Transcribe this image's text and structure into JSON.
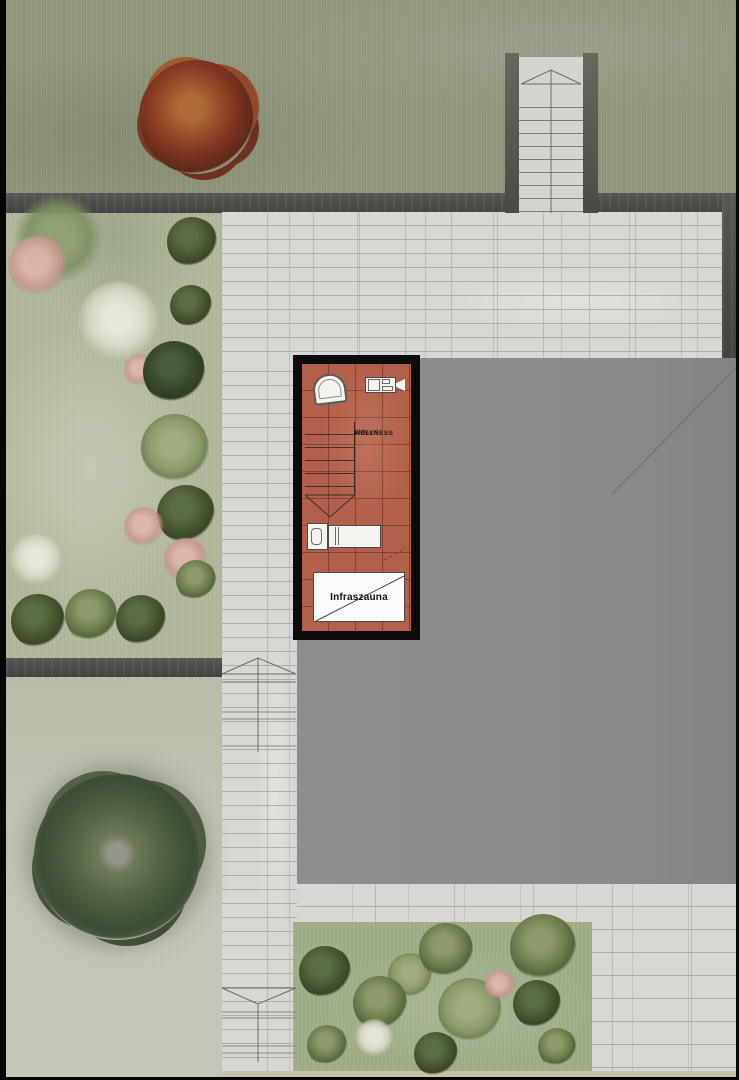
{
  "plan": {
    "room_label": "WELLNESS",
    "room_area": "13.64 m²",
    "sauna_label": "Infraszauna"
  },
  "palette": {
    "grass_top": "#8f957c",
    "garden_left": "#aeb69a",
    "grass_bottom_left": "#c2c6b6",
    "garden_bottom": "#9dab87",
    "road_dark": "#4b4d48",
    "paving_light": "#d8d7d3",
    "roof_gray": "#8a8a8a",
    "tile_terracotta": "#b2604b",
    "plan_frame_black": "#0c0c0c",
    "fixture_white": "#f4f3f0",
    "red_tree": "#833721",
    "big_tree": "#47563b"
  },
  "vegetation": [
    {
      "type": "red-tree",
      "name": "red-maple-tree",
      "cx": 196,
      "cy": 117,
      "r": 57
    },
    {
      "type": "big-tree",
      "name": "large-green-tree",
      "cx": 117,
      "cy": 857,
      "r": 83
    },
    {
      "type": "soft-green",
      "name": "shrub-mass",
      "cx": 58,
      "cy": 238,
      "r": 45
    },
    {
      "type": "pink",
      "name": "flowering-shrub",
      "cx": 38,
      "cy": 266,
      "r": 30
    },
    {
      "type": "white",
      "name": "white-flower-bed",
      "cx": 118,
      "cy": 322,
      "r": 40
    },
    {
      "type": "pink",
      "name": "flowering-shrub",
      "cx": 140,
      "cy": 370,
      "r": 16
    },
    {
      "type": "bush-dark",
      "name": "bush",
      "cx": 192,
      "cy": 242,
      "r": 25
    },
    {
      "type": "bush-dark",
      "name": "bush",
      "cx": 191,
      "cy": 306,
      "r": 21
    },
    {
      "type": "bush-darker",
      "name": "bush",
      "cx": 174,
      "cy": 372,
      "r": 31
    },
    {
      "type": "bush-light",
      "name": "bush",
      "cx": 175,
      "cy": 448,
      "r": 34
    },
    {
      "type": "bush-dark",
      "name": "bush",
      "cx": 186,
      "cy": 514,
      "r": 29
    },
    {
      "type": "pink",
      "name": "flowering-shrub",
      "cx": 144,
      "cy": 527,
      "r": 20
    },
    {
      "type": "pink",
      "name": "flowering-shrub",
      "cx": 186,
      "cy": 560,
      "r": 22
    },
    {
      "type": "bush-green",
      "name": "bush",
      "cx": 196,
      "cy": 580,
      "r": 20
    },
    {
      "type": "white",
      "name": "white-flower-bed",
      "cx": 36,
      "cy": 560,
      "r": 26
    },
    {
      "type": "bush-dark",
      "name": "bush",
      "cx": 38,
      "cy": 621,
      "r": 27
    },
    {
      "type": "bush-green",
      "name": "bush",
      "cx": 91,
      "cy": 615,
      "r": 26
    },
    {
      "type": "bush-dark",
      "name": "bush",
      "cx": 141,
      "cy": 620,
      "r": 25
    },
    {
      "type": "bush-light",
      "name": "bush",
      "cx": 470,
      "cy": 1010,
      "r": 32
    },
    {
      "type": "bush-light",
      "name": "bush",
      "cx": 410,
      "cy": 975,
      "r": 22
    },
    {
      "type": "bush-dark",
      "name": "bush",
      "cx": 325,
      "cy": 972,
      "r": 26
    },
    {
      "type": "bush-green",
      "name": "bush",
      "cx": 446,
      "cy": 950,
      "r": 27
    },
    {
      "type": "bush-green",
      "name": "bush",
      "cx": 543,
      "cy": 947,
      "r": 33
    },
    {
      "type": "bush-green",
      "name": "bush",
      "cx": 380,
      "cy": 1003,
      "r": 27
    },
    {
      "type": "bush-dark",
      "name": "bush",
      "cx": 537,
      "cy": 1004,
      "r": 24
    },
    {
      "type": "bush-green",
      "name": "bush",
      "cx": 327,
      "cy": 1045,
      "r": 20
    },
    {
      "type": "bush-dark",
      "name": "bush",
      "cx": 436,
      "cy": 1054,
      "r": 22
    },
    {
      "type": "bush-green",
      "name": "bush",
      "cx": 557,
      "cy": 1047,
      "r": 19
    },
    {
      "type": "white",
      "name": "white-flower-bed",
      "cx": 374,
      "cy": 1038,
      "r": 19
    },
    {
      "type": "pink",
      "name": "flowering-shrub",
      "cx": 500,
      "cy": 985,
      "r": 15
    }
  ]
}
